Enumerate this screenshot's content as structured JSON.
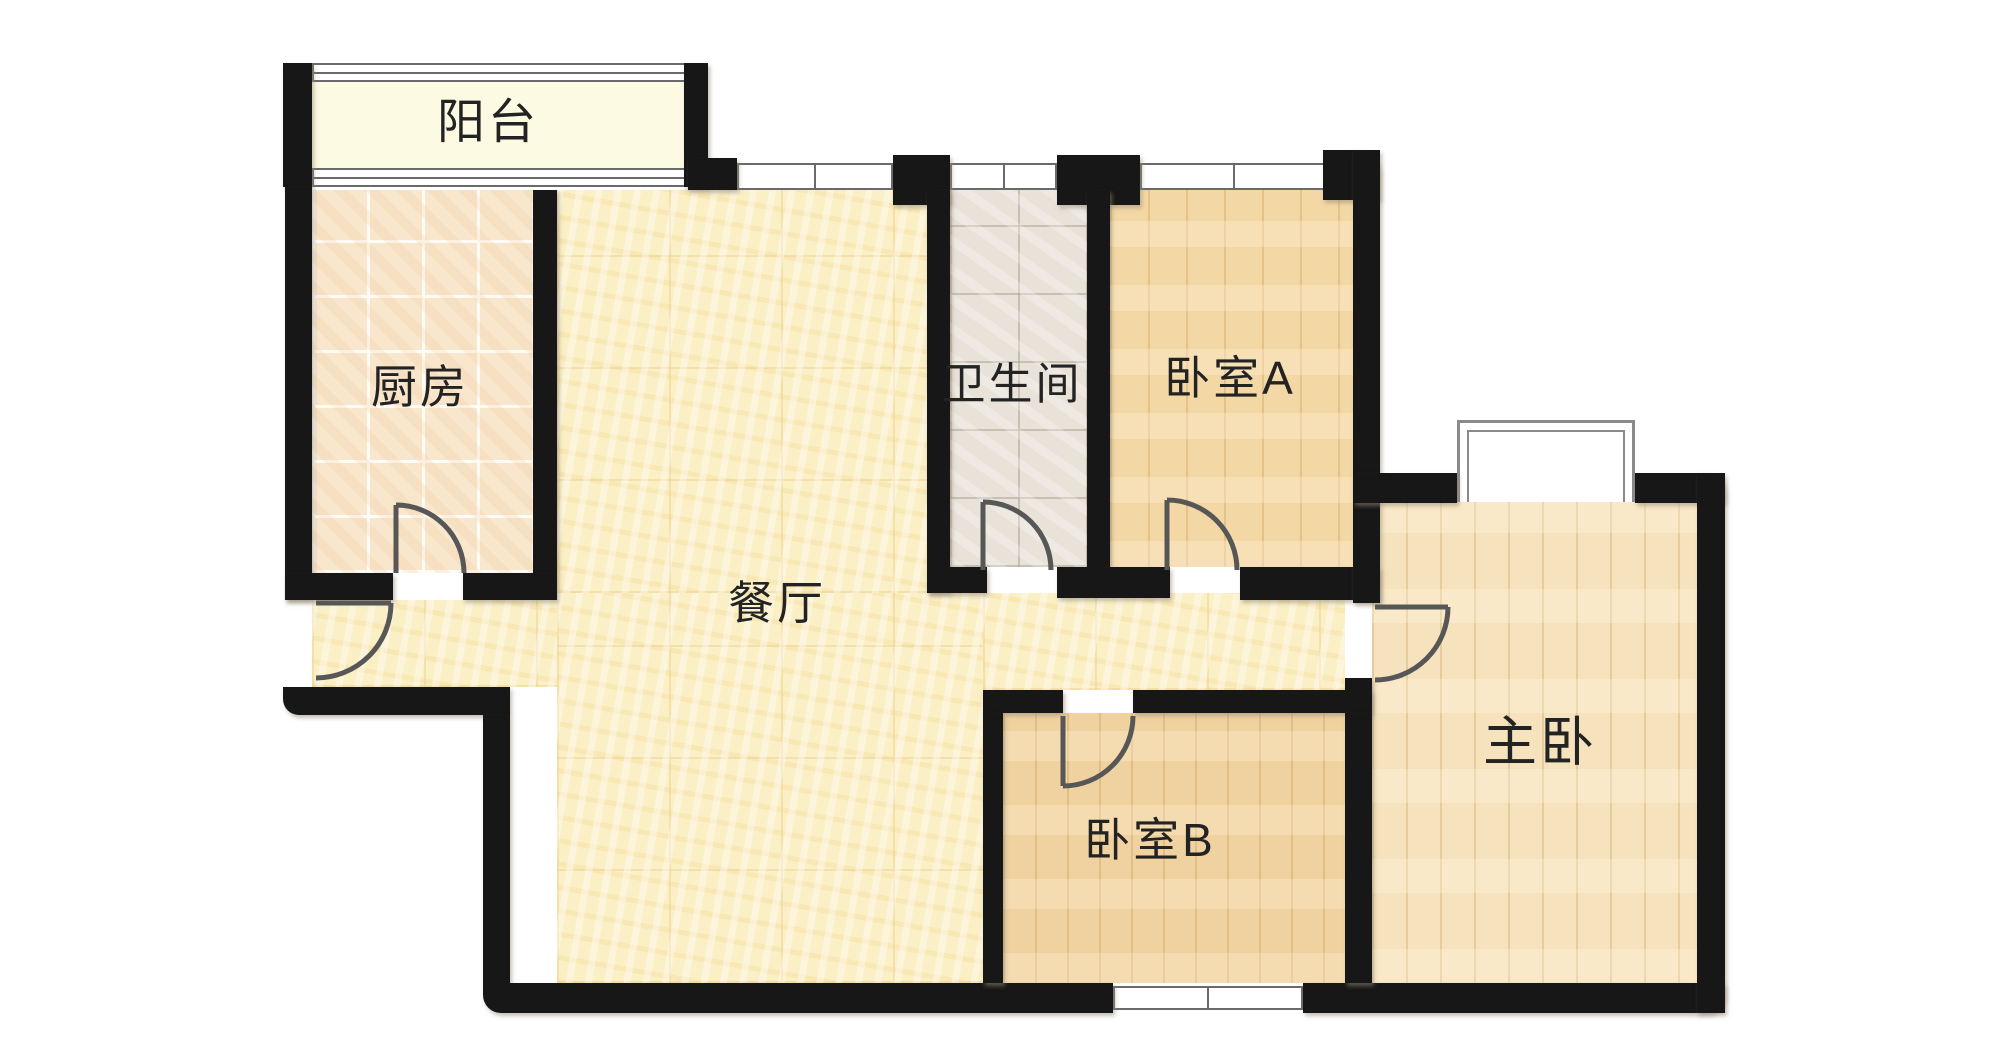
{
  "plan": {
    "width": 2006,
    "height": 1056,
    "background": "#ffffff",
    "wall_color": "#171717",
    "door_color": "#575757",
    "window_frame_color": "#6a6a6a",
    "rooms": [
      {
        "id": "balcony",
        "label": "阳台",
        "label_x": 488,
        "label_y": 117,
        "label_size": 48
      },
      {
        "id": "kitchen",
        "label": "厨房",
        "label_x": 420,
        "label_y": 384,
        "label_size": 46
      },
      {
        "id": "dining",
        "label": "餐厅",
        "label_x": 777,
        "label_y": 600,
        "label_size": 46
      },
      {
        "id": "bathroom",
        "label": "卫生间",
        "label_x": 1012,
        "label_y": 380,
        "label_size": 44
      },
      {
        "id": "bedroom-a",
        "label": "卧室A",
        "label_x": 1230,
        "label_y": 375,
        "label_size": 46
      },
      {
        "id": "bedroom-b",
        "label": "卧室B",
        "label_x": 1150,
        "label_y": 837,
        "label_size": 46
      },
      {
        "id": "master-bedroom",
        "label": "主卧",
        "label_x": 1540,
        "label_y": 737,
        "label_size": 54
      }
    ],
    "floors": [
      {
        "room": "balcony",
        "x": 312,
        "y": 82,
        "w": 376,
        "h": 86,
        "texture": "t-balcony"
      },
      {
        "room": "kitchen",
        "x": 312,
        "y": 190,
        "w": 221,
        "h": 383,
        "texture": "t-tile-warm"
      },
      {
        "room": "dining",
        "x": 557,
        "y": 190,
        "w": 370,
        "h": 403,
        "texture": "t-cream"
      },
      {
        "room": "dining",
        "x": 557,
        "y": 593,
        "w": 426,
        "h": 390,
        "texture": "t-cream"
      },
      {
        "room": "dining",
        "x": 312,
        "y": 600,
        "w": 245,
        "h": 87,
        "texture": "t-cream"
      },
      {
        "room": "dining",
        "x": 983,
        "y": 593,
        "w": 362,
        "h": 97,
        "texture": "t-cream"
      },
      {
        "room": "bathroom",
        "x": 950,
        "y": 190,
        "w": 137,
        "h": 377,
        "texture": "t-tile-gray"
      },
      {
        "room": "bedroom-a",
        "x": 1110,
        "y": 190,
        "w": 243,
        "h": 377,
        "texture": "t-plank-a"
      },
      {
        "room": "bedroom-b",
        "x": 1003,
        "y": 713,
        "w": 342,
        "h": 270,
        "texture": "t-plank-b"
      },
      {
        "room": "master-bedroom",
        "x": 1372,
        "y": 500,
        "w": 325,
        "h": 483,
        "texture": "t-plank-m"
      }
    ],
    "walls": [
      {
        "id": "balcony-left-post",
        "x": 283,
        "y": 63,
        "w": 29,
        "h": 124
      },
      {
        "id": "balcony-right-post",
        "x": 684,
        "y": 63,
        "w": 24,
        "h": 124
      },
      {
        "id": "outer-left-upper",
        "x": 285,
        "y": 187,
        "w": 27,
        "h": 413
      },
      {
        "id": "kitchen-dining-divider",
        "x": 533,
        "y": 190,
        "w": 24,
        "h": 383
      },
      {
        "id": "kitchen-south-left",
        "x": 285,
        "y": 573,
        "w": 108,
        "h": 27
      },
      {
        "id": "kitchen-south-right",
        "x": 463,
        "y": 573,
        "w": 94,
        "h": 27
      },
      {
        "id": "entry-step-wall",
        "x": 283,
        "y": 687,
        "w": 227,
        "h": 28,
        "r": "0 0 0 16px"
      },
      {
        "id": "outer-left-lower",
        "x": 483,
        "y": 715,
        "w": 27,
        "h": 268
      },
      {
        "id": "outer-bottom-left",
        "x": 483,
        "y": 983,
        "w": 630,
        "h": 30,
        "r": "0 0 0 18px"
      },
      {
        "id": "outer-bottom-right",
        "x": 1303,
        "y": 983,
        "w": 422,
        "h": 30,
        "r": "0 0 18px 0"
      },
      {
        "id": "dining-north-post",
        "x": 688,
        "y": 158,
        "w": 49,
        "h": 32
      },
      {
        "id": "bathroom-north-left-post",
        "x": 893,
        "y": 155,
        "w": 57,
        "h": 50
      },
      {
        "id": "bathroom-left-wall",
        "x": 927,
        "y": 190,
        "w": 23,
        "h": 403
      },
      {
        "id": "bathroom-north-right-post",
        "x": 1057,
        "y": 155,
        "w": 83,
        "h": 50
      },
      {
        "id": "bathroom-bedroom-a-divider",
        "x": 1087,
        "y": 190,
        "w": 23,
        "h": 377
      },
      {
        "id": "south-wall-bathroom",
        "x": 927,
        "y": 567,
        "w": 60,
        "h": 26
      },
      {
        "id": "south-wall-mid",
        "x": 1057,
        "y": 567,
        "w": 113,
        "h": 31
      },
      {
        "id": "south-wall-bedroom-a",
        "x": 1240,
        "y": 567,
        "w": 140,
        "h": 33
      },
      {
        "id": "bedroom-a-ne-corner",
        "x": 1323,
        "y": 150,
        "w": 57,
        "h": 50,
        "r": "0 22px 0 0"
      },
      {
        "id": "bedroom-a-right-wall",
        "x": 1353,
        "y": 150,
        "w": 27,
        "h": 453
      },
      {
        "id": "hall-master-jamb",
        "x": 1345,
        "y": 678,
        "w": 27,
        "h": 35
      },
      {
        "id": "bedroom-b-north-left",
        "x": 983,
        "y": 690,
        "w": 80,
        "h": 23
      },
      {
        "id": "bedroom-b-north-right",
        "x": 1133,
        "y": 690,
        "w": 239,
        "h": 23
      },
      {
        "id": "bedroom-b-left-wall",
        "x": 983,
        "y": 713,
        "w": 20,
        "h": 270
      },
      {
        "id": "bedroom-b-master-divider",
        "x": 1345,
        "y": 713,
        "w": 27,
        "h": 270
      },
      {
        "id": "master-north-left",
        "x": 1353,
        "y": 473,
        "w": 104,
        "h": 30
      },
      {
        "id": "master-north-right",
        "x": 1635,
        "y": 473,
        "w": 90,
        "h": 30,
        "r": "0 18px 0 0"
      },
      {
        "id": "outer-right",
        "x": 1697,
        "y": 473,
        "w": 28,
        "h": 540
      }
    ],
    "windows": [
      {
        "id": "balcony-window-top",
        "x": 312,
        "y": 63,
        "w": 376,
        "h": 19,
        "style": "triple"
      },
      {
        "id": "balcony-window-bottom",
        "x": 312,
        "y": 168,
        "w": 376,
        "h": 19,
        "style": "triple"
      },
      {
        "id": "dining-north-window",
        "x": 737,
        "y": 163,
        "w": 156,
        "h": 27,
        "style": "double"
      },
      {
        "id": "bathroom-north-window",
        "x": 950,
        "y": 163,
        "w": 107,
        "h": 27,
        "style": "double"
      },
      {
        "id": "bedroom-a-north-window",
        "x": 1140,
        "y": 163,
        "w": 187,
        "h": 27,
        "style": "double"
      },
      {
        "id": "bedroom-b-south-window",
        "x": 1113,
        "y": 986,
        "w": 190,
        "h": 24,
        "style": "double"
      }
    ],
    "bay_window": {
      "id": "master-bay-window",
      "x": 1457,
      "y": 420,
      "w": 178,
      "h": 82
    },
    "doors": [
      {
        "id": "kitchen-door",
        "leaf": "M 396 573 L 396 505",
        "arc": "M 396 505 A 68 68 0 0 1 464 573"
      },
      {
        "id": "entry-door",
        "leaf": "M 316 603 L 391 603",
        "arc": "M 391 603 A 75 75 0 0 1 316 678"
      },
      {
        "id": "bathroom-door",
        "leaf": "M 983 570 L 983 502",
        "arc": "M 983 502 A 68 68 0 0 1 1051 570"
      },
      {
        "id": "bedroom-a-door",
        "leaf": "M 1167 570 L 1167 500",
        "arc": "M 1167 500 A 70 70 0 0 1 1237 570"
      },
      {
        "id": "bedroom-b-door",
        "leaf": "M 1063 716 L 1063 786",
        "arc": "M 1063 786 A 70 70 0 0 0 1133 716"
      },
      {
        "id": "master-bedroom-door",
        "leaf": "M 1375 607 L 1448 607",
        "arc": "M 1448 607 A 73 73 0 0 1 1375 680"
      }
    ]
  }
}
